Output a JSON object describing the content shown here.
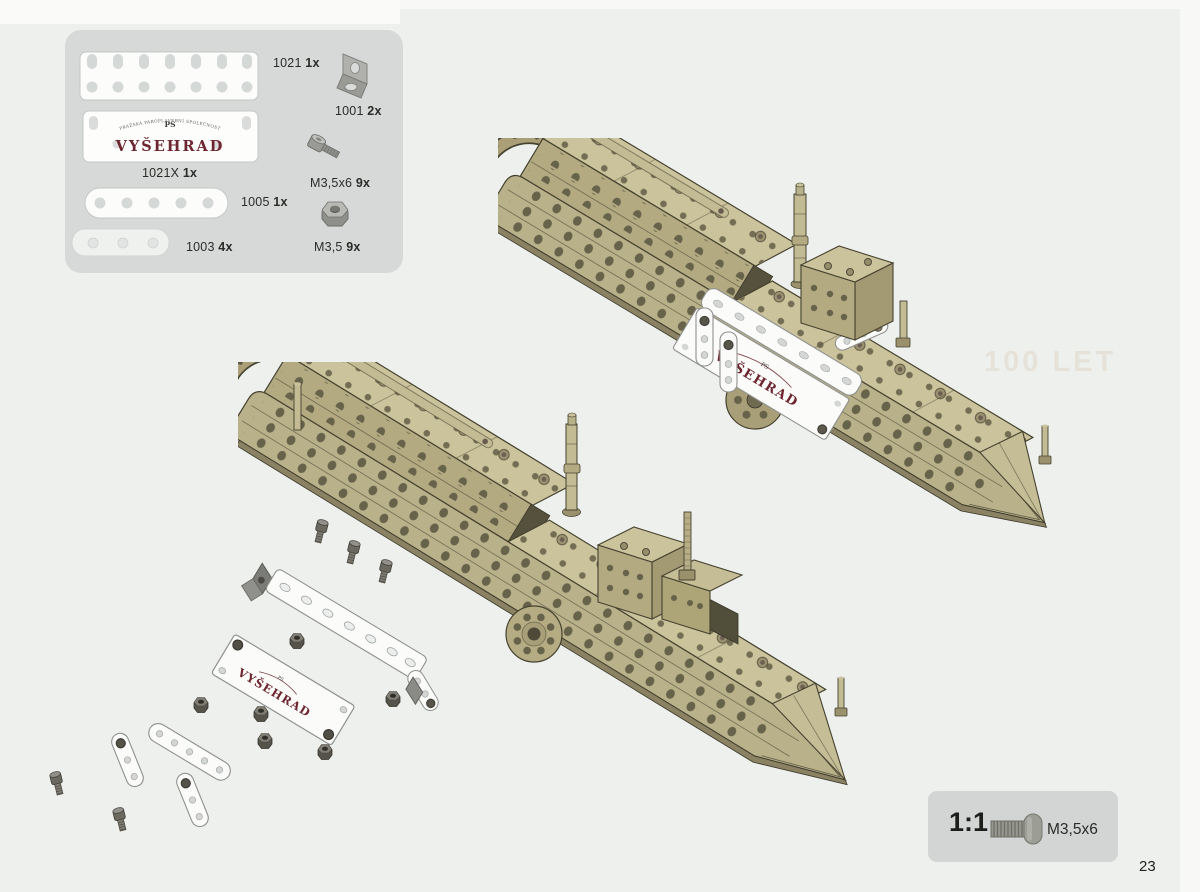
{
  "page": {
    "number": "23",
    "ghost_text": "100 LET"
  },
  "parts_panel": {
    "plate_1021": {
      "code": "1021",
      "count": "1x"
    },
    "bracket_1001": {
      "code": "1001",
      "count": "2x"
    },
    "plate_1021x": {
      "code": "1021X",
      "count": "1x"
    },
    "screw_m35x6": {
      "code": "M3,5x6",
      "count": "9x"
    },
    "strip_1005": {
      "code": "1005",
      "count": "1x"
    },
    "nut_m35": {
      "code": "M3,5",
      "count": "9x"
    },
    "strip_1003": {
      "code": "1003",
      "count": "4x"
    },
    "logo_plate": {
      "arc_text": "PRAŽSKÁ PAROPLAVEBNÍ SPOLEČNOST",
      "monogram": "PS",
      "name": "VYŠEHRAD"
    }
  },
  "boats": {
    "upper_plate_text": "VYŠEHRAD",
    "exploded_plate_text": "VYŠEHRAD"
  },
  "scale_box": {
    "ratio": "1:1",
    "screw_label": "M3,5x6"
  },
  "colors": {
    "paper": "#eef0ed",
    "panel_bg": "#d6d9d8",
    "khaki": "#b9b18a",
    "khaki_light": "#cbc39c",
    "khaki_dark": "#a09772",
    "outline": "#45422f",
    "hole": "#67624a",
    "white_part": "#fbfbfa",
    "metal": "#9b9c98",
    "metal_dark": "#55524a",
    "logo_red": "#6d2630"
  }
}
